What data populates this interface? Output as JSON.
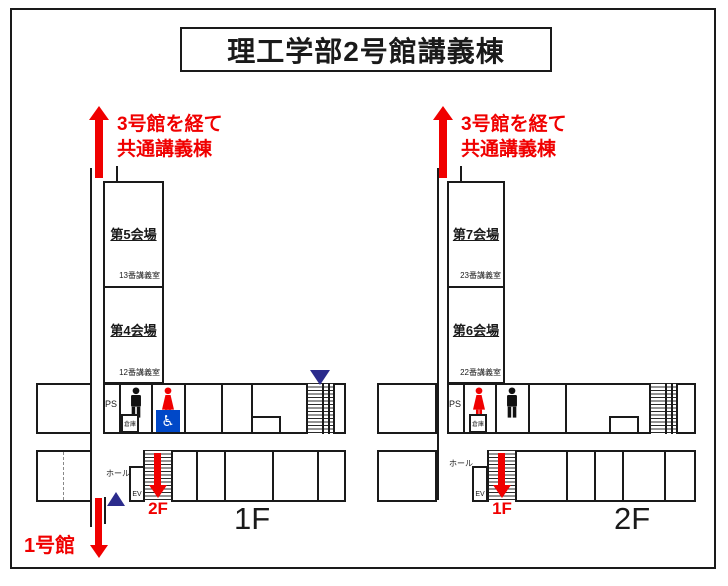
{
  "title": "理工学部2号館講義棟",
  "colors": {
    "accent_red": "#F00000",
    "triangle_navy": "#2B2B8C",
    "wheelchair_blue": "#0048C8",
    "line_black": "#1A1A1A"
  },
  "floors": {
    "f1": {
      "big_label": "1F",
      "route_note": {
        "line1": "3号館を経て",
        "line2": "共通講義棟"
      },
      "rooms": [
        {
          "title": "第5会場",
          "sub": "13番講義室"
        },
        {
          "title": "第4会場",
          "sub": "12番講義室"
        }
      ],
      "ps": "PS",
      "storage": "倉庫",
      "wheelchair_symbol": "♿",
      "hall": "ホール",
      "elevator": "EV",
      "stairs_to": "2F",
      "exit_label": "1号館"
    },
    "f2": {
      "big_label": "2F",
      "route_note": {
        "line1": "3号館を経て",
        "line2": "共通講義棟"
      },
      "rooms": [
        {
          "title": "第7会場",
          "sub": "23番講義室"
        },
        {
          "title": "第6会場",
          "sub": "22番講義室"
        }
      ],
      "ps": "PS",
      "storage": "倉庫",
      "hall": "ホール",
      "elevator": "EV",
      "stairs_to": "1F"
    }
  }
}
